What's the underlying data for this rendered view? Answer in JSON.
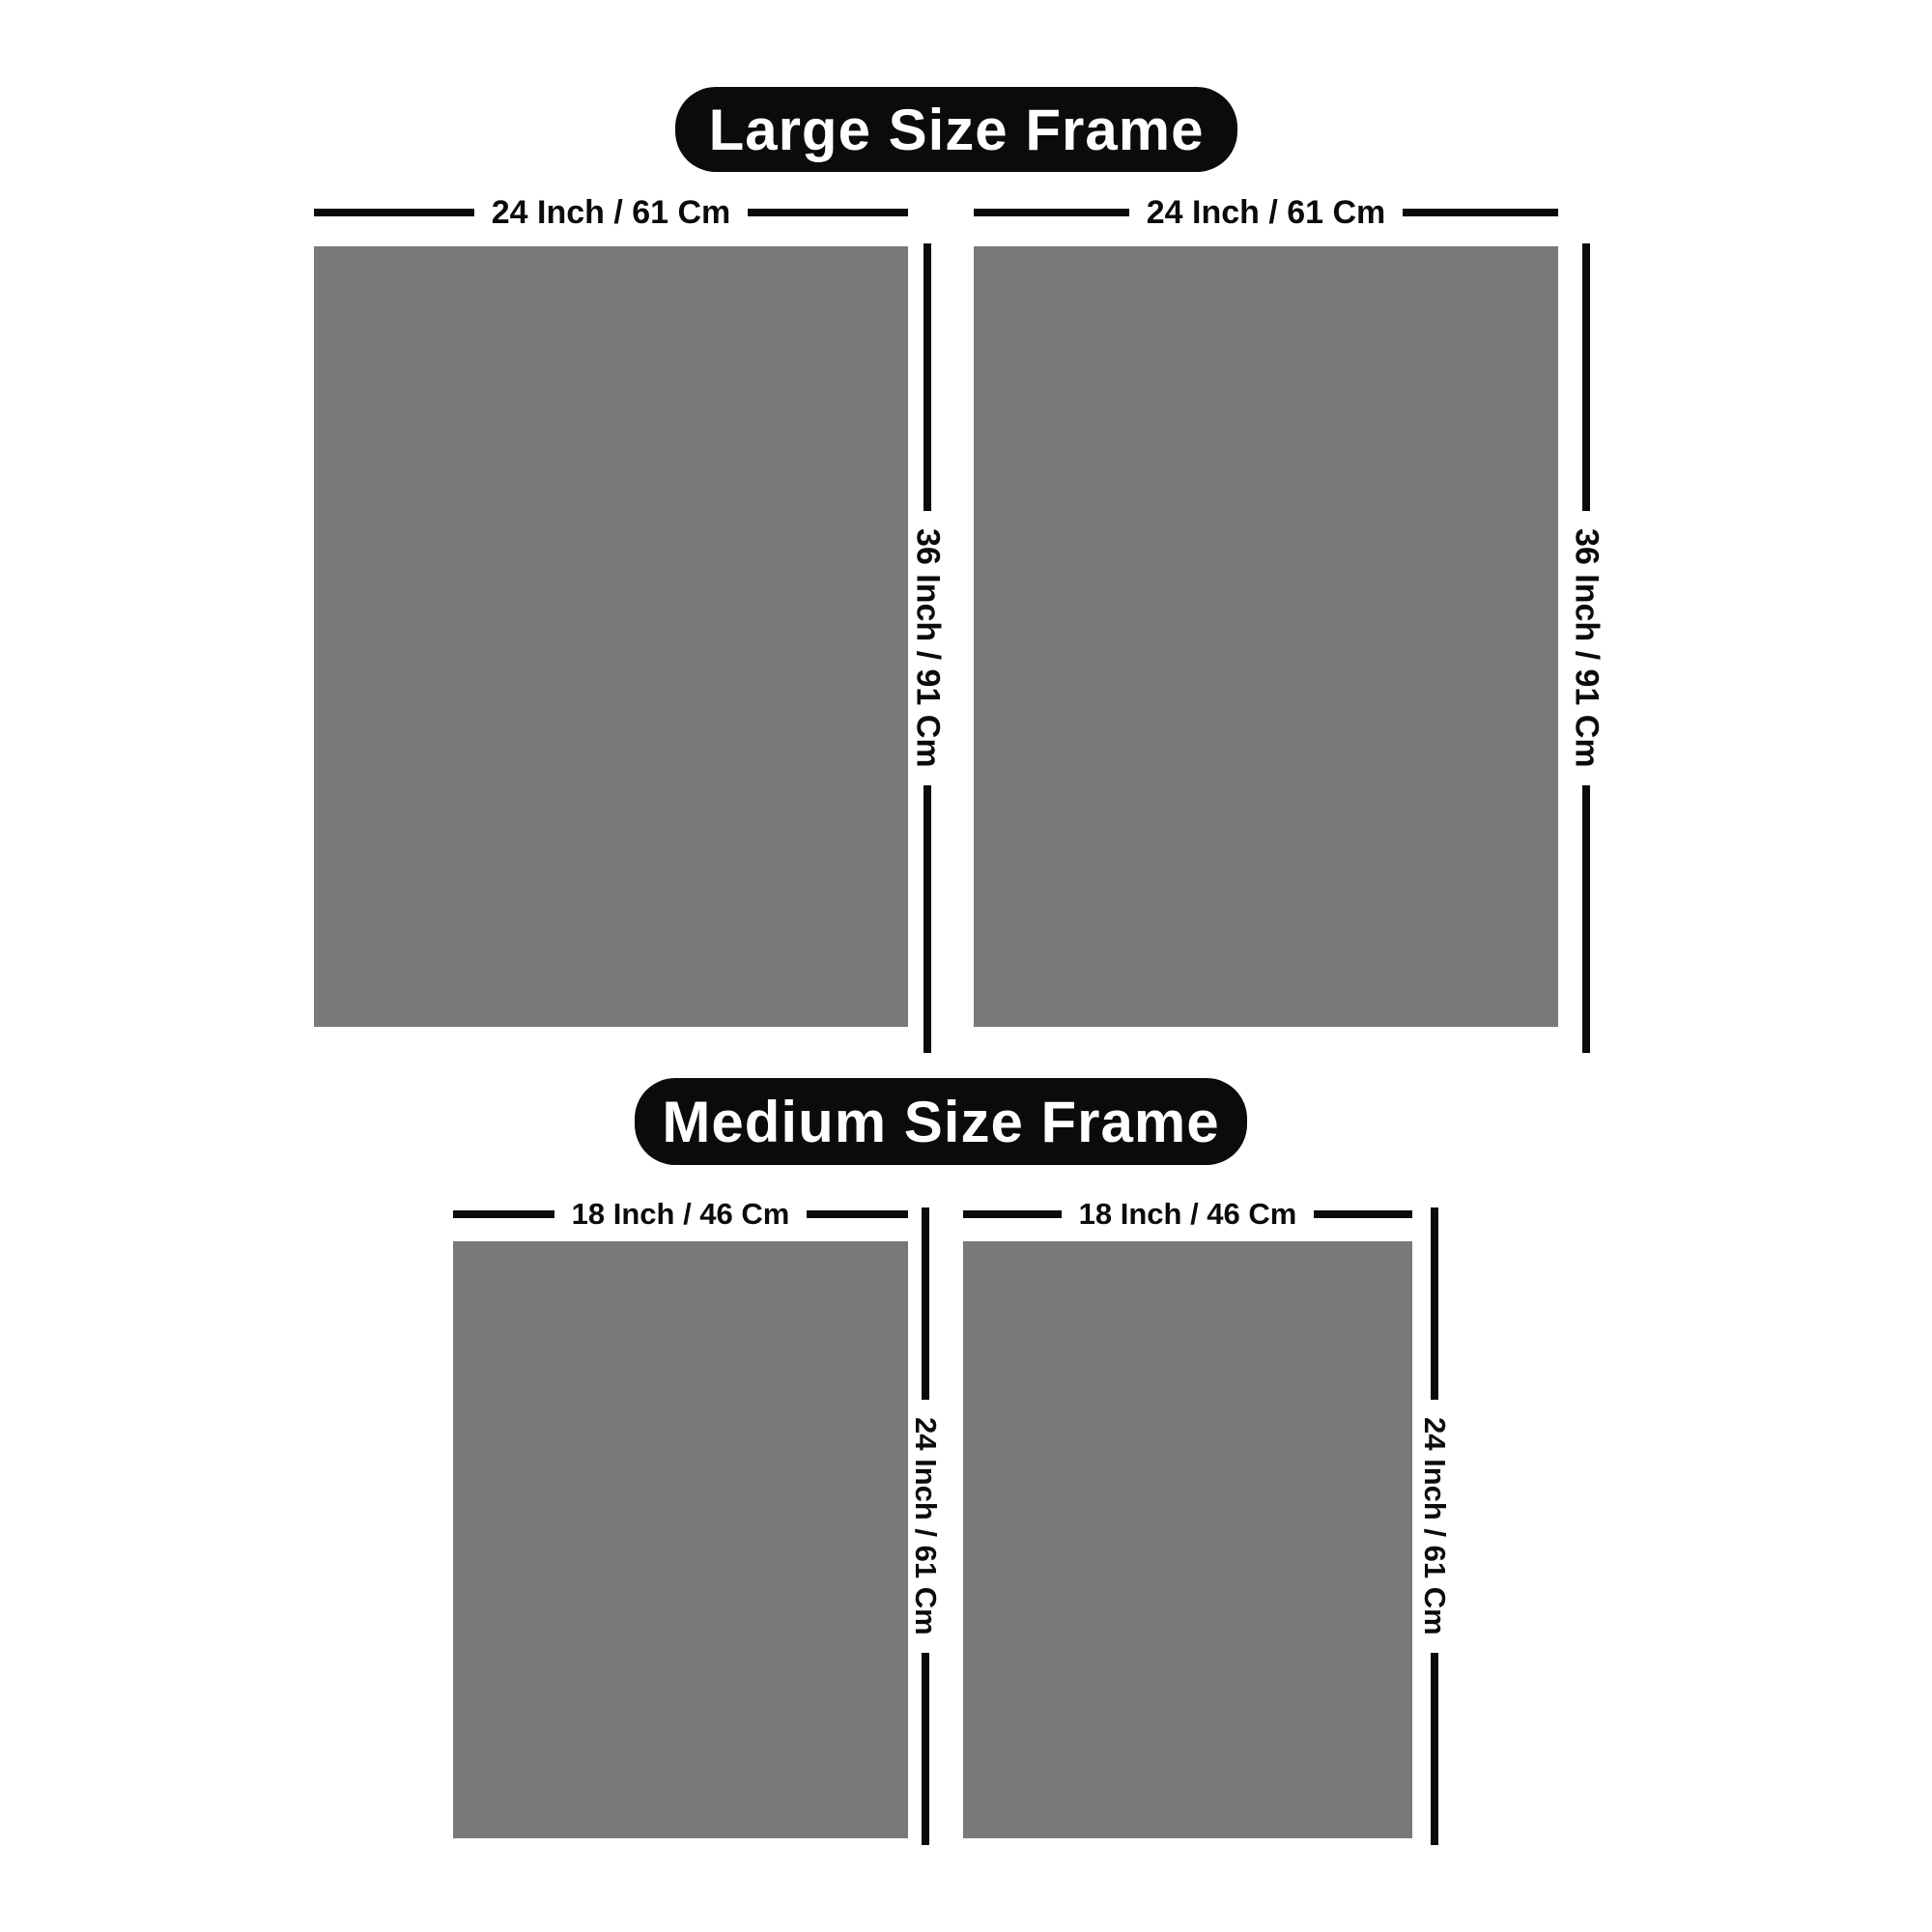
{
  "colors": {
    "page_bg": "#ffffff",
    "frame_gray": "#797979",
    "ink": "#0b0b0b",
    "badge_bg": "#0b0b0b",
    "badge_text": "#ffffff"
  },
  "sections": [
    {
      "id": "large",
      "title": "Large Size Frame",
      "width_label": "24 Inch / 61 Cm",
      "height_label": "36 Inch / 91 Cm",
      "frame_count": 2
    },
    {
      "id": "medium",
      "title": "Medium Size Frame",
      "width_label": "18 Inch / 46 Cm",
      "height_label": "24 Inch / 61 Cm",
      "frame_count": 2
    }
  ]
}
